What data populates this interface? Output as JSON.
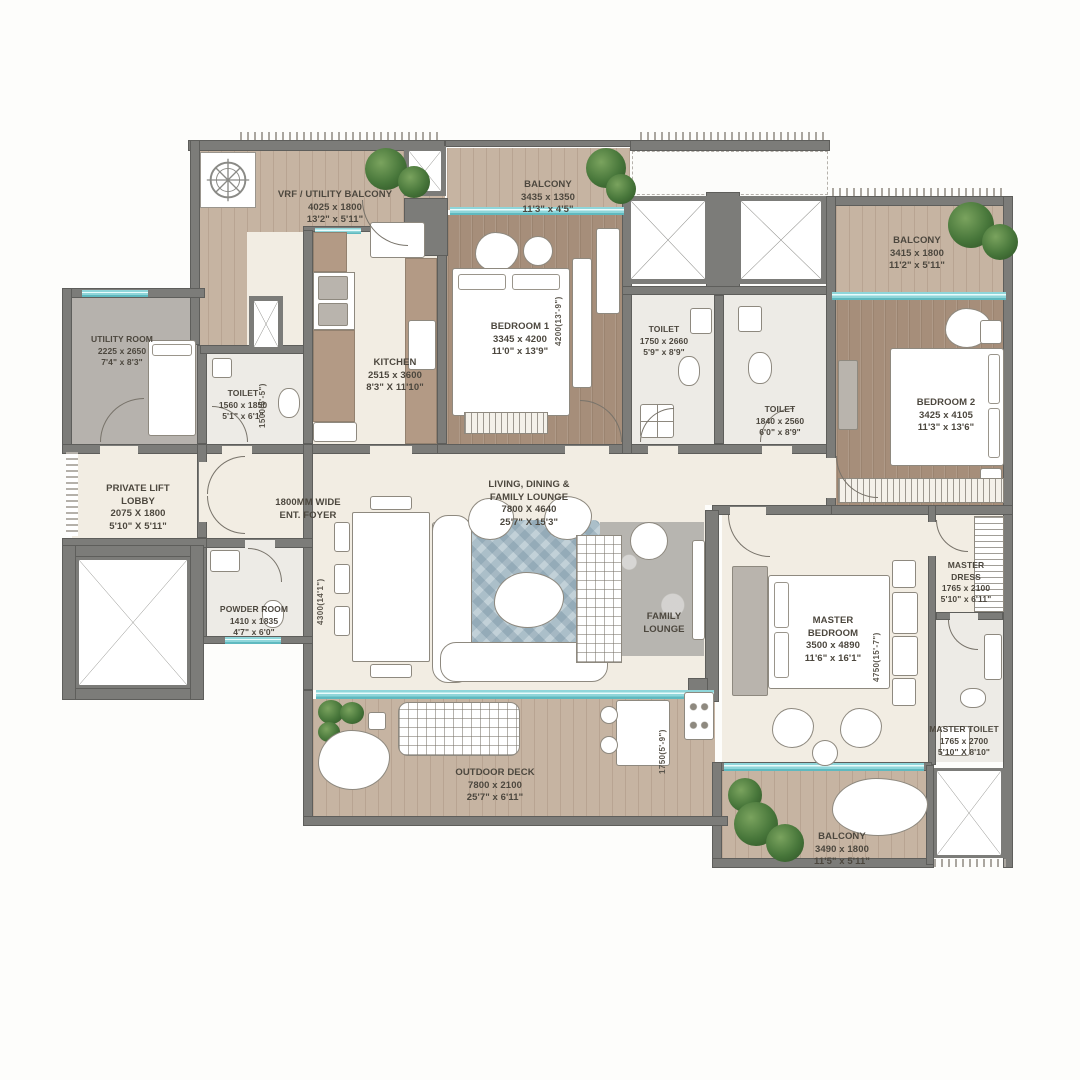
{
  "plan_title": "Apartment Floor Plan",
  "rooms": {
    "vrf_balcony": {
      "name": "VRF / UTILITY BALCONY",
      "mm": "4025 x 1800",
      "ft": "13'2\" x 5'11\""
    },
    "balcony_top": {
      "name": "BALCONY",
      "mm": "3435 x 1350",
      "ft": "11'3\" x 4'5\""
    },
    "bedroom1": {
      "name": "BEDROOM 1",
      "mm": "3345 x 4200",
      "ft": "11'0\" x 13'9\""
    },
    "toilet1": {
      "name": "TOILET",
      "mm": "1750 x 2660",
      "ft": "5'9\" x 8'9\""
    },
    "toilet2": {
      "name": "TOILET",
      "mm": "1840 x 2560",
      "ft": "6'0\" x 8'9\""
    },
    "balcony_right": {
      "name": "BALCONY",
      "mm": "3415 x 1800",
      "ft": "11'2\" x 5'11\""
    },
    "bedroom2": {
      "name": "BEDROOM 2",
      "mm": "3425 x 4105",
      "ft": "11'3\" x 13'6\""
    },
    "utility": {
      "name": "UTILITY ROOM",
      "mm": "2225 x 2650",
      "ft": "7'4\" x 8'3\""
    },
    "toilet3": {
      "name": "TOILET",
      "mm": "1560 x 1850",
      "ft": "5'1\" x 6'1\""
    },
    "kitchen": {
      "name": "KITCHEN",
      "mm": "2515 x 3600",
      "ft": "8'3\" X 11'10\""
    },
    "lobby": {
      "name": "PRIVATE LIFT\nLOBBY",
      "mm": "2075 X 1800",
      "ft": "5'10\" X 5'11\""
    },
    "foyer": {
      "name": "1800MM WIDE\nENT. FOYER"
    },
    "powder": {
      "name": "POWDER ROOM",
      "mm": "1410 x 1835",
      "ft": "4'7\" x 6'0\""
    },
    "living": {
      "name": "LIVING, DINING &\nFAMILY LOUNGE",
      "mm": "7800 X 4640",
      "ft": "25'7\" X 15'3\""
    },
    "family_lounge": {
      "name": "FAMILY\nLOUNGE"
    },
    "master_bedroom": {
      "name": "MASTER\nBEDROOM",
      "mm": "3500 x 4890",
      "ft": "11'6\" x 16'1\""
    },
    "master_dress": {
      "name": "MASTER\nDRESS",
      "mm": "1765 x 2100",
      "ft": "5'10\" x 6'11\""
    },
    "master_toilet": {
      "name": "MASTER TOILET",
      "mm": "1765 x 2700",
      "ft": "5'10\" X 8'10\""
    },
    "deck": {
      "name": "OUTDOOR DECK",
      "mm": "7800 x 2100",
      "ft": "25'7\" x 6'11\""
    },
    "balcony_bottom": {
      "name": "BALCONY",
      "mm": "3490 x 1800",
      "ft": "11'5\" x 5'11\""
    }
  },
  "dims": {
    "living_depth": "4300(14'1\")",
    "toilet3_width": "1500(5'-5\")",
    "bedroom1_len": "4200(13'-9\")",
    "master_len": "4750(15'-7\")",
    "deck_right": "1750(5'-9\")"
  },
  "colors": {
    "wall": "#7c7c79",
    "balcony_wood": "#c6b4a2",
    "bedroom_wood": "#a68e7a",
    "interior_cream": "#f2ede3",
    "window_glass": "#8fd6da",
    "plant_green": "#47763a",
    "label_text": "#4c473e"
  }
}
